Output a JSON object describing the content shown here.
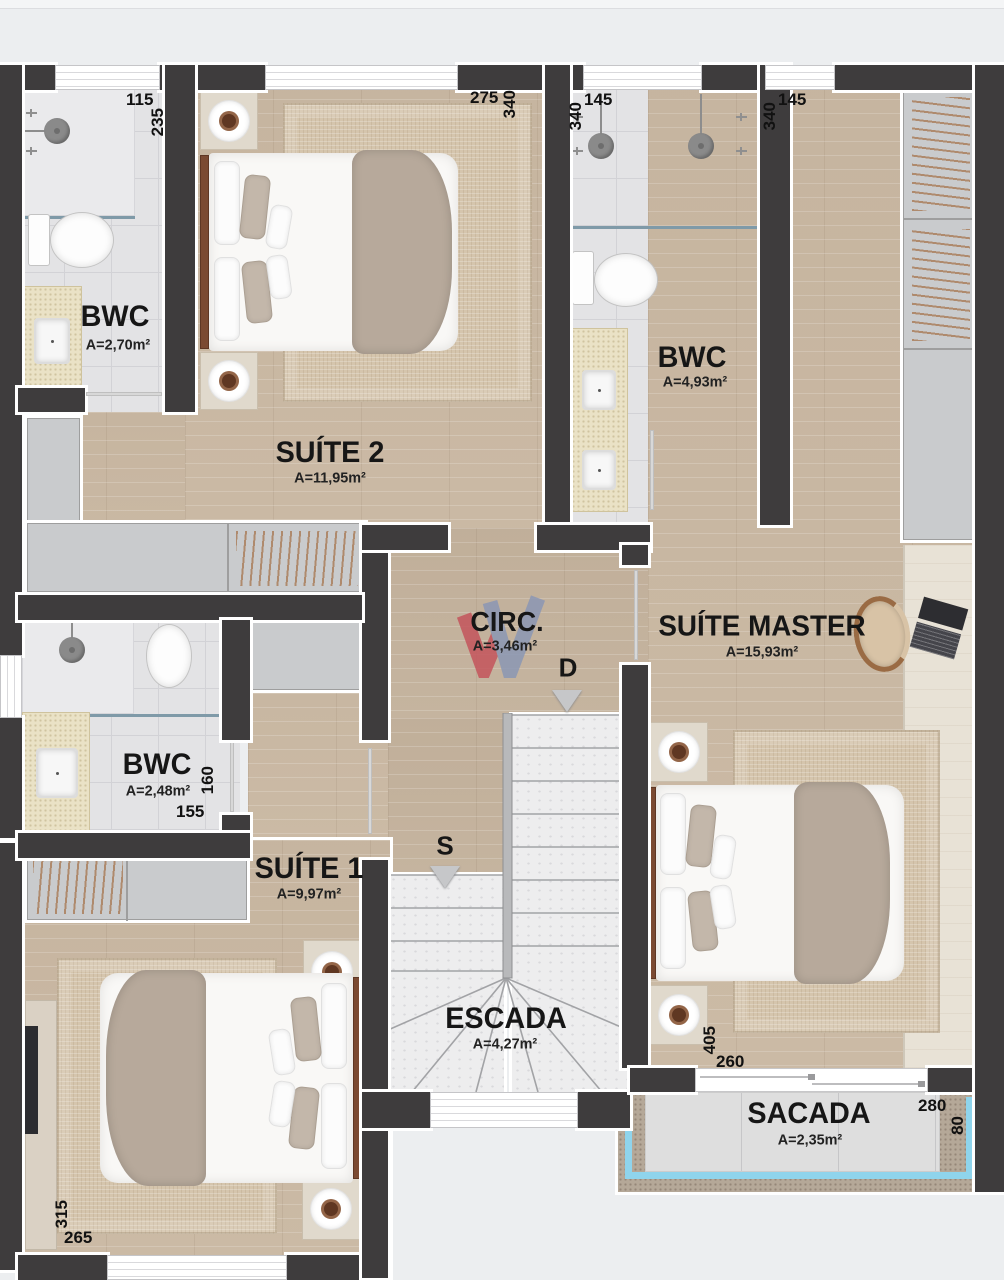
{
  "plan_title": "Pavimento superior - planta humanizada",
  "rooms": {
    "bwc1": {
      "name": "BWC",
      "area": "A=2,70m²"
    },
    "suite2": {
      "name": "SUÍTE 2",
      "area": "A=11,95m²"
    },
    "bwc2": {
      "name": "BWC",
      "area": "A=4,93m²"
    },
    "suite_master": {
      "name": "SUÍTE MASTER",
      "area": "A=15,93m²"
    },
    "circ": {
      "name": "CIRC.",
      "area": "A=3,46m²"
    },
    "bwc3": {
      "name": "BWC",
      "area": "A=2,48m²"
    },
    "suite1": {
      "name": "SUÍTE 1",
      "area": "A=9,97m²"
    },
    "escada": {
      "name": "ESCADA",
      "area": "A=4,27m²"
    },
    "sacada": {
      "name": "SACADA",
      "area": "A=2,35m²"
    }
  },
  "stair_markers": {
    "up": "S",
    "down": "D"
  },
  "dimensions": {
    "bwc1_w": "115",
    "bwc1_h": "235",
    "suite2_w": "275",
    "suite2_h": "340",
    "bwc2_w": "145",
    "bwc2_h": "340",
    "suite_master_w": "145",
    "suite_master_h": "340",
    "suite_master_len": "405",
    "suite_master_door": "260",
    "sacada_w": "280",
    "sacada_h": "80",
    "bwc3_w": "155",
    "bwc3_h": "160",
    "suite1_h": "315",
    "suite1_w": "265"
  },
  "icons": {
    "logo_watermark": "w-chevrons",
    "stair_direction": "triangle-down",
    "bedside_lamp": "disc-with-brown-center",
    "shower": "round-shower-head",
    "laptop": "laptop-on-desk"
  },
  "colors": {
    "wall": "#3e3c3d",
    "wood_floor": "#cbbaa5",
    "bath_tile": "#e3e3e5",
    "marble_stair": "#ededee",
    "balcony_glass": "#8fd4ec",
    "concrete_border": "#b5a898",
    "logo_red": "#c4555c",
    "logo_blue": "#8b97b4"
  }
}
